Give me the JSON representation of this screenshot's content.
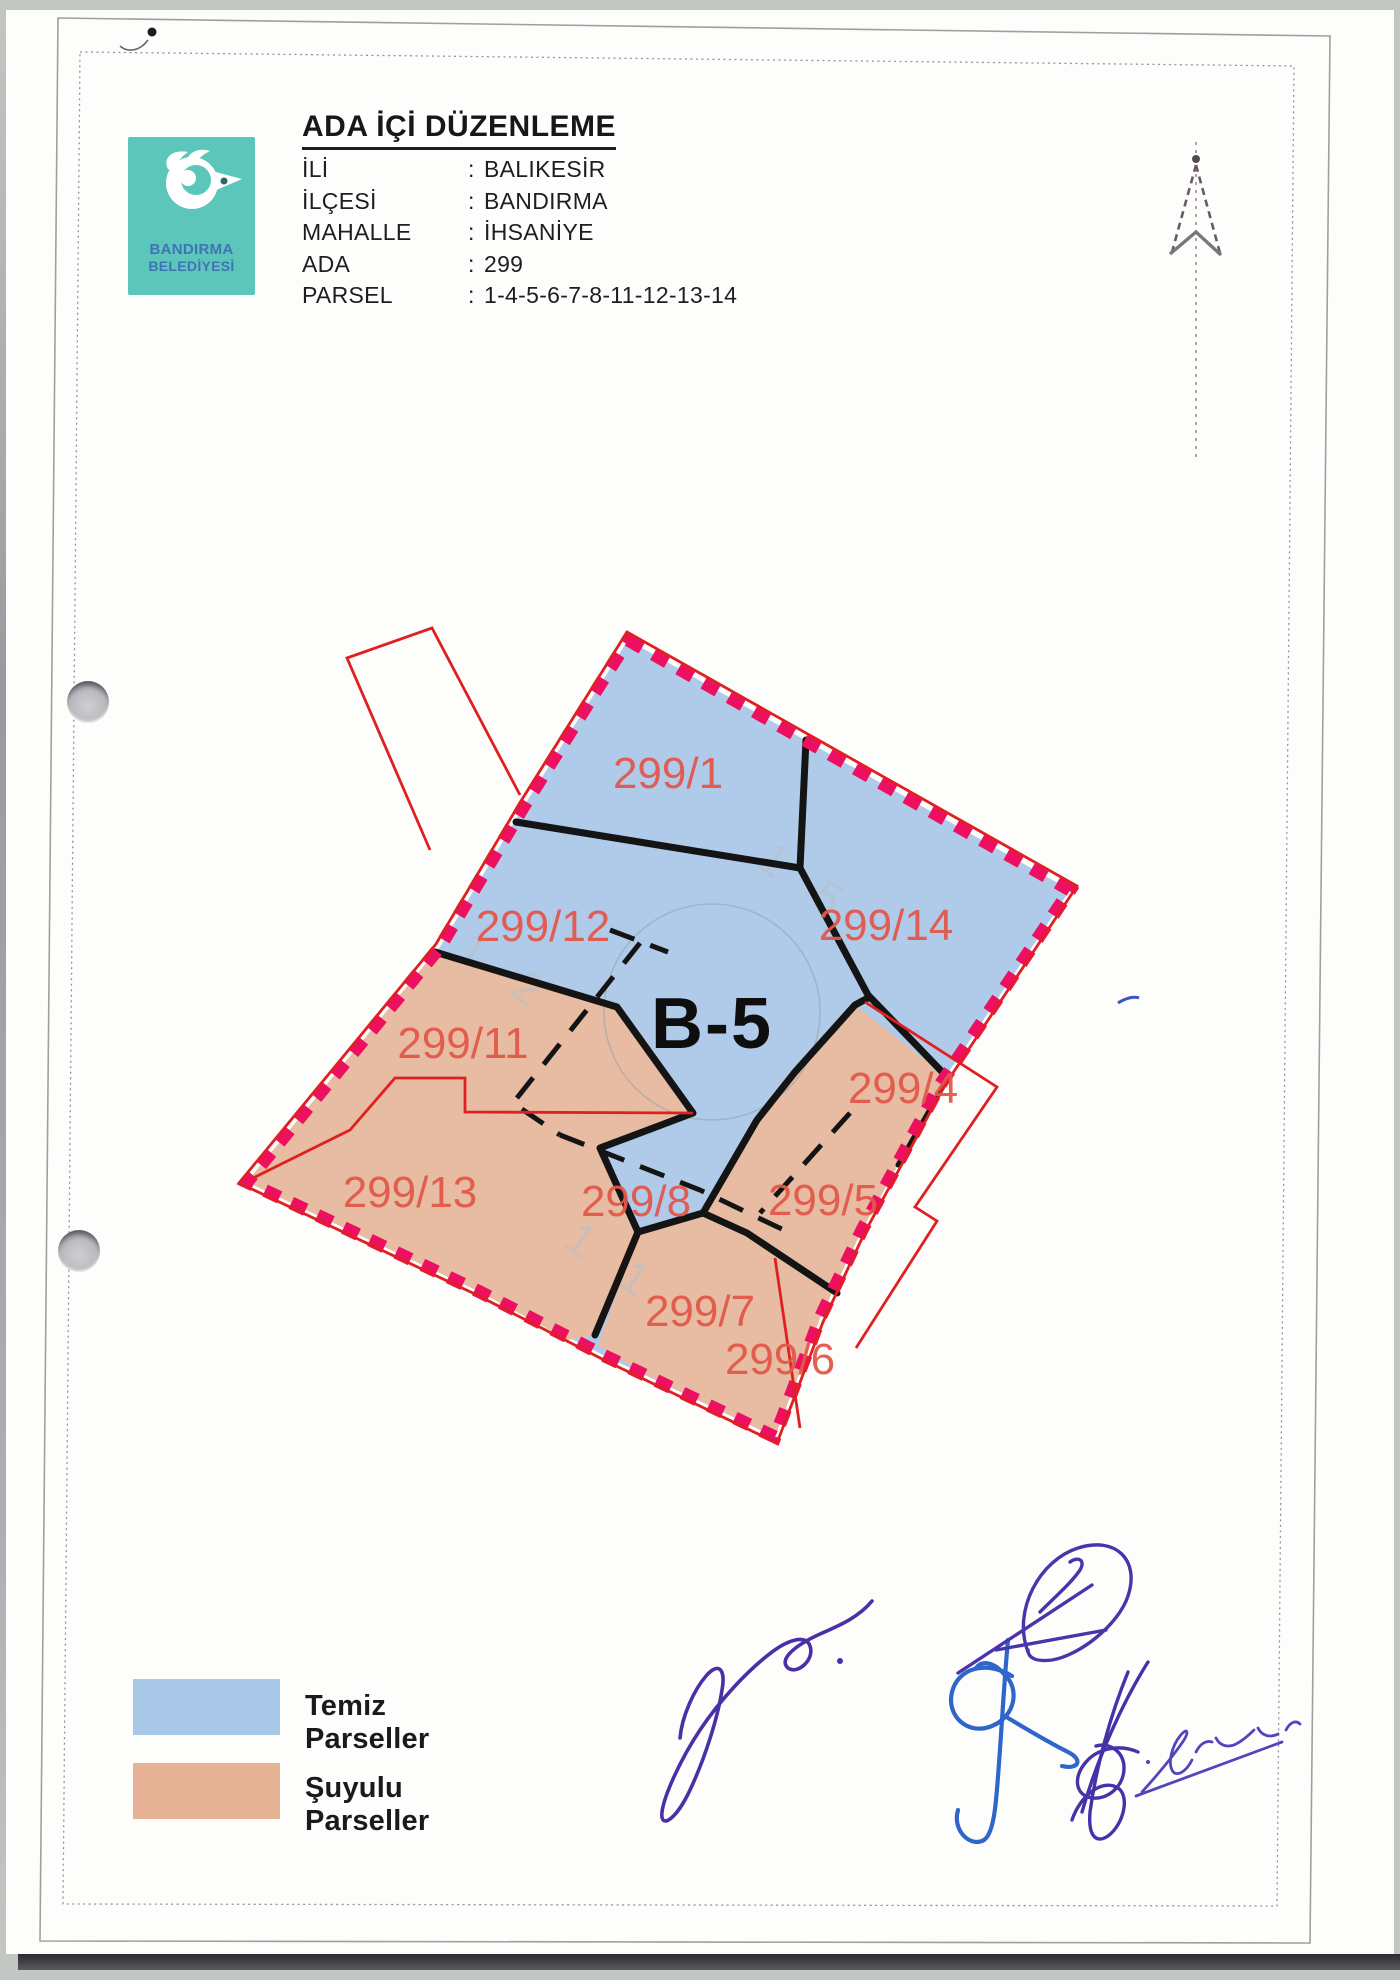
{
  "logo": {
    "org_line1": "BANDIRMA",
    "org_line2": "BELEDİYESİ",
    "bg_color": "#5cc6ba",
    "text_color": "#3f74b4"
  },
  "header": {
    "title": "ADA İÇİ DÜZENLEME",
    "fields": [
      {
        "label": "İLİ",
        "sep": ":",
        "value": "BALIKESİR"
      },
      {
        "label": "İLÇESİ",
        "sep": ":",
        "value": "BANDIRMA"
      },
      {
        "label": "MAHALLE",
        "sep": ":",
        "value": "İHSANİYE"
      },
      {
        "label": "ADA",
        "sep": ":",
        "value": "299"
      },
      {
        "label": "PARSEL",
        "sep": ":",
        "value": "1-4-5-6-7-8-11-12-13-14"
      }
    ]
  },
  "map": {
    "block_label": "B-5",
    "parcels": [
      {
        "label": "299/1"
      },
      {
        "label": "299/12"
      },
      {
        "label": "299/14"
      },
      {
        "label": "299/11"
      },
      {
        "label": "299/4"
      },
      {
        "label": "299/13"
      },
      {
        "label": "299/8"
      },
      {
        "label": "299/5"
      },
      {
        "label": "299/7"
      },
      {
        "label": "299/6"
      }
    ],
    "ghost_marks": [
      {
        "text": "1 5"
      },
      {
        "text": "1 1"
      },
      {
        "text": "1 2"
      }
    ],
    "colors": {
      "clean_parcel_fill": "#afcbe9",
      "shared_parcel_fill": "#e7bca2",
      "block_boundary_dash": "#ee1060",
      "old_parcel_line": "#e02020",
      "new_line": "#141414",
      "parcel_label": "#e2584a"
    }
  },
  "legend": {
    "items": [
      {
        "label": "Temiz Parseller",
        "color": "#a9c8e8"
      },
      {
        "label": "Şuyulu Parseller",
        "color": "#e6b295"
      }
    ]
  }
}
